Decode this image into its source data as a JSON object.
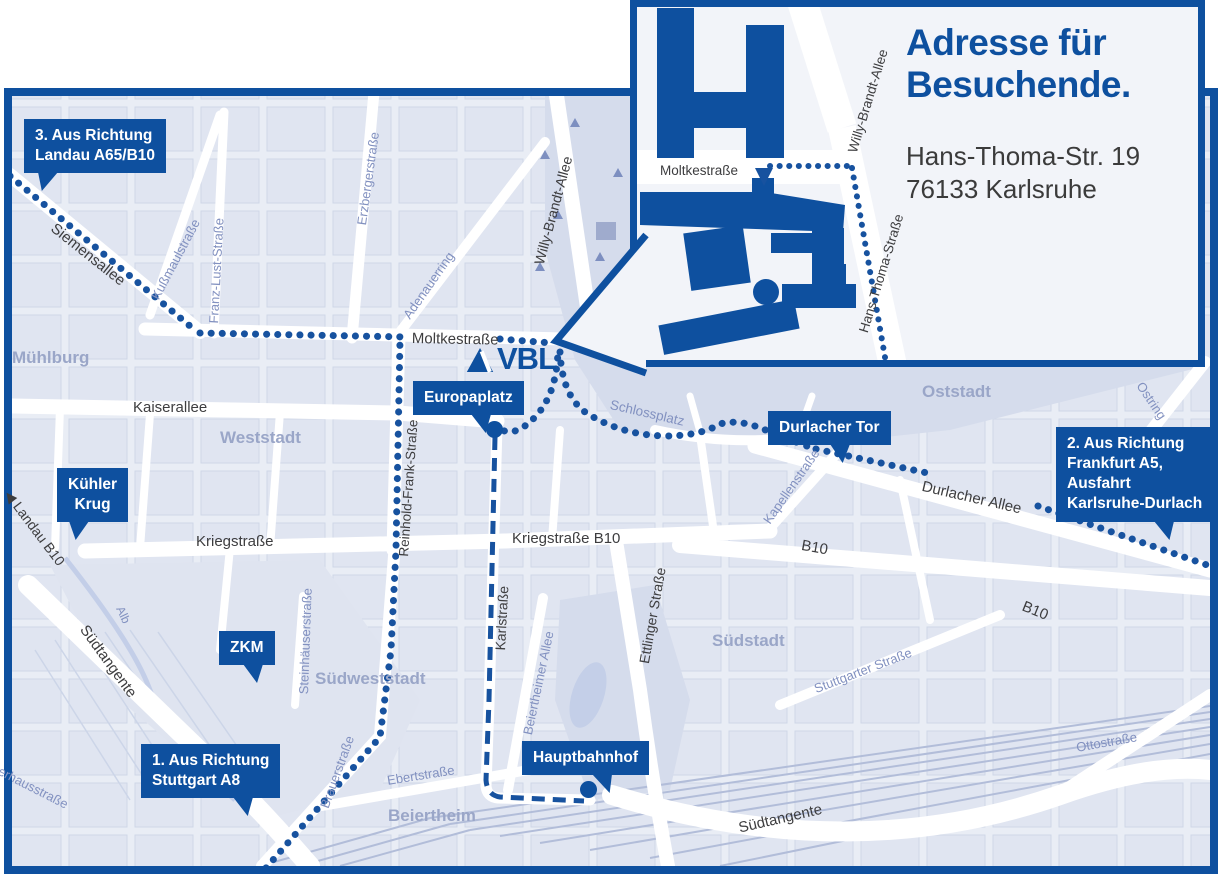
{
  "colors": {
    "accent": "#0e509f",
    "map_bg": "#e9edf5",
    "block": "#dee3f0",
    "park": "#d5dcec",
    "rail": "#b2bdd9"
  },
  "logo": {
    "text": "VBL"
  },
  "inset": {
    "heading": "Adresse für Besuchende.",
    "address_line1": "Hans-Thoma-Str. 19",
    "address_line2": "76133 Karlsruhe"
  },
  "map": {
    "labels": [
      {
        "text": "Siemensallee",
        "x": 58,
        "y": 220,
        "rot": 38.5,
        "tone": "dark"
      },
      {
        "text": "Moltkestraße",
        "x": 412,
        "y": 330,
        "rot": 1,
        "tone": "dark"
      },
      {
        "text": "Willy-Brandt-Allee",
        "x": 531,
        "y": 262,
        "rot": -75,
        "tone": "dark",
        "size": 14
      },
      {
        "text": "Kaiserallee",
        "x": 133,
        "y": 399,
        "rot": 0,
        "tone": "dark"
      },
      {
        "text": "Kriegstraße",
        "x": 196,
        "y": 533,
        "rot": 0,
        "tone": "dark"
      },
      {
        "text": "Kriegstraße B10",
        "x": 512,
        "y": 530,
        "rot": 0,
        "tone": "dark"
      },
      {
        "text": "Reinhold-Frank-Straße",
        "x": 396,
        "y": 556,
        "rot": -86,
        "tone": "dark",
        "size": 13.5
      },
      {
        "text": "Karlstraße",
        "x": 492,
        "y": 650,
        "rot": -87,
        "tone": "dark",
        "size": 14
      },
      {
        "text": "Ettlinger Straße",
        "x": 636,
        "y": 662,
        "rot": -80,
        "tone": "dark",
        "size": 14
      },
      {
        "text": "Durlacher Allee",
        "x": 924,
        "y": 478,
        "rot": 13,
        "tone": "dark"
      },
      {
        "text": "B10",
        "x": 803,
        "y": 537,
        "rot": 10,
        "tone": "dark"
      },
      {
        "text": "B10",
        "x": 1026,
        "y": 598,
        "rot": 22,
        "tone": "dark"
      },
      {
        "text": "◀ Landau B10",
        "x": 14,
        "y": 487,
        "rot": 53,
        "tone": "dark",
        "size": 14
      },
      {
        "text": "Südtangente",
        "x": 90,
        "y": 622,
        "rot": 54,
        "tone": "dark"
      },
      {
        "text": "Südtangente",
        "x": 737,
        "y": 820,
        "rot": -13,
        "tone": "dark"
      },
      {
        "text": "Kußmaulstraße",
        "x": 148,
        "y": 295,
        "rot": -62,
        "tone": "minor"
      },
      {
        "text": "Franz-Lust-Straße",
        "x": 206,
        "y": 323,
        "rot": -87,
        "tone": "minor"
      },
      {
        "text": "Erzbergerstraße",
        "x": 354,
        "y": 224,
        "rot": -82,
        "tone": "minor"
      },
      {
        "text": "Adenauerring",
        "x": 400,
        "y": 313,
        "rot": -55,
        "tone": "minor"
      },
      {
        "text": "Schlossplatz",
        "x": 612,
        "y": 397,
        "rot": 13,
        "tone": "minor",
        "size": 13.5
      },
      {
        "text": "Kapellenstraße",
        "x": 760,
        "y": 518,
        "rot": -55,
        "tone": "minor"
      },
      {
        "text": "Ostring",
        "x": 1146,
        "y": 379,
        "rot": 56,
        "tone": "minor"
      },
      {
        "text": "Stuttgarter Straße",
        "x": 812,
        "y": 682,
        "rot": -21,
        "tone": "minor"
      },
      {
        "text": "Steinhäuserstraße",
        "x": 296,
        "y": 694,
        "rot": -88,
        "tone": "minor"
      },
      {
        "text": "Brauerstraße",
        "x": 317,
        "y": 805,
        "rot": -70,
        "tone": "minor"
      },
      {
        "text": "Ebertstraße",
        "x": 386,
        "y": 773,
        "rot": -9,
        "tone": "minor"
      },
      {
        "text": "Beiertheimer Allee",
        "x": 520,
        "y": 733,
        "rot": -78,
        "tone": "minor"
      },
      {
        "text": "Ottostraße",
        "x": 1075,
        "y": 740,
        "rot": -10,
        "tone": "minor"
      },
      {
        "text": "Pulverhausstraße",
        "x": -20,
        "y": 752,
        "rot": 27,
        "tone": "minor"
      },
      {
        "text": "Alb",
        "x": 126,
        "y": 604,
        "rot": 65,
        "tone": "minor",
        "size": 12
      },
      {
        "text": "Mühlburg",
        "x": 12,
        "y": 348,
        "rot": 0,
        "tone": "district"
      },
      {
        "text": "Weststadt",
        "x": 220,
        "y": 428,
        "rot": 0,
        "tone": "district"
      },
      {
        "text": "Oststadt",
        "x": 922,
        "y": 382,
        "rot": 0,
        "tone": "district"
      },
      {
        "text": "Südstadt",
        "x": 712,
        "y": 631,
        "rot": 0,
        "tone": "district"
      },
      {
        "text": "Südweststadt",
        "x": 315,
        "y": 669,
        "rot": 0,
        "tone": "district"
      },
      {
        "text": "Beiertheim",
        "x": 388,
        "y": 806,
        "rot": 0,
        "tone": "district"
      },
      {
        "text": "Moltkestraße",
        "x": 660,
        "y": 163,
        "rot": 0,
        "tone": "inset"
      },
      {
        "text": "Willy-Brandt-Allee",
        "x": 845,
        "y": 150,
        "rot": -73,
        "tone": "inset"
      },
      {
        "text": "Hans-Thoma-Straße",
        "x": 856,
        "y": 330,
        "rot": -73,
        "tone": "inset"
      }
    ],
    "callouts": [
      {
        "id": "landau",
        "text": "3. Aus Richtung\nLandau A65/B10",
        "x": 24,
        "y": 119,
        "tip_left": 14,
        "tip_skew": -18
      },
      {
        "id": "kuehler-krug",
        "text": "Kühler\nKrug",
        "x": 57,
        "y": 468,
        "tip_left": 12,
        "tip_skew": -10,
        "align": "center"
      },
      {
        "id": "zkm",
        "text": "ZKM",
        "x": 219,
        "y": 631,
        "tip_left": 24,
        "tip_skew": 12
      },
      {
        "id": "stuttgart",
        "text": "1. Aus Richtung\nStuttgart A8",
        "x": 141,
        "y": 744,
        "tip_left": 92,
        "tip_skew": 14
      },
      {
        "id": "europaplatz",
        "text": "Europaplatz",
        "x": 413,
        "y": 381,
        "tip_left": 58,
        "tip_skew": 14
      },
      {
        "id": "durlacher-tor",
        "text": "Durlacher Tor",
        "x": 768,
        "y": 411,
        "tip_left": 62,
        "tip_skew": 8
      },
      {
        "id": "frankfurt",
        "text": "2. Aus Richtung\nFrankfurt A5,\nAusfahrt\nKarlsruhe-Durlach",
        "x": 1056,
        "y": 427,
        "tip_left": 98,
        "tip_skew": 16
      },
      {
        "id": "hauptbahnhof",
        "text": "Hauptbahnhof",
        "x": 522,
        "y": 741,
        "tip_left": 70,
        "tip_skew": 22
      }
    ],
    "markers": [
      {
        "id": "europaplatz-dot",
        "x": 494,
        "y": 429
      },
      {
        "id": "hauptbahnhof-dot",
        "x": 588,
        "y": 789
      }
    ]
  }
}
